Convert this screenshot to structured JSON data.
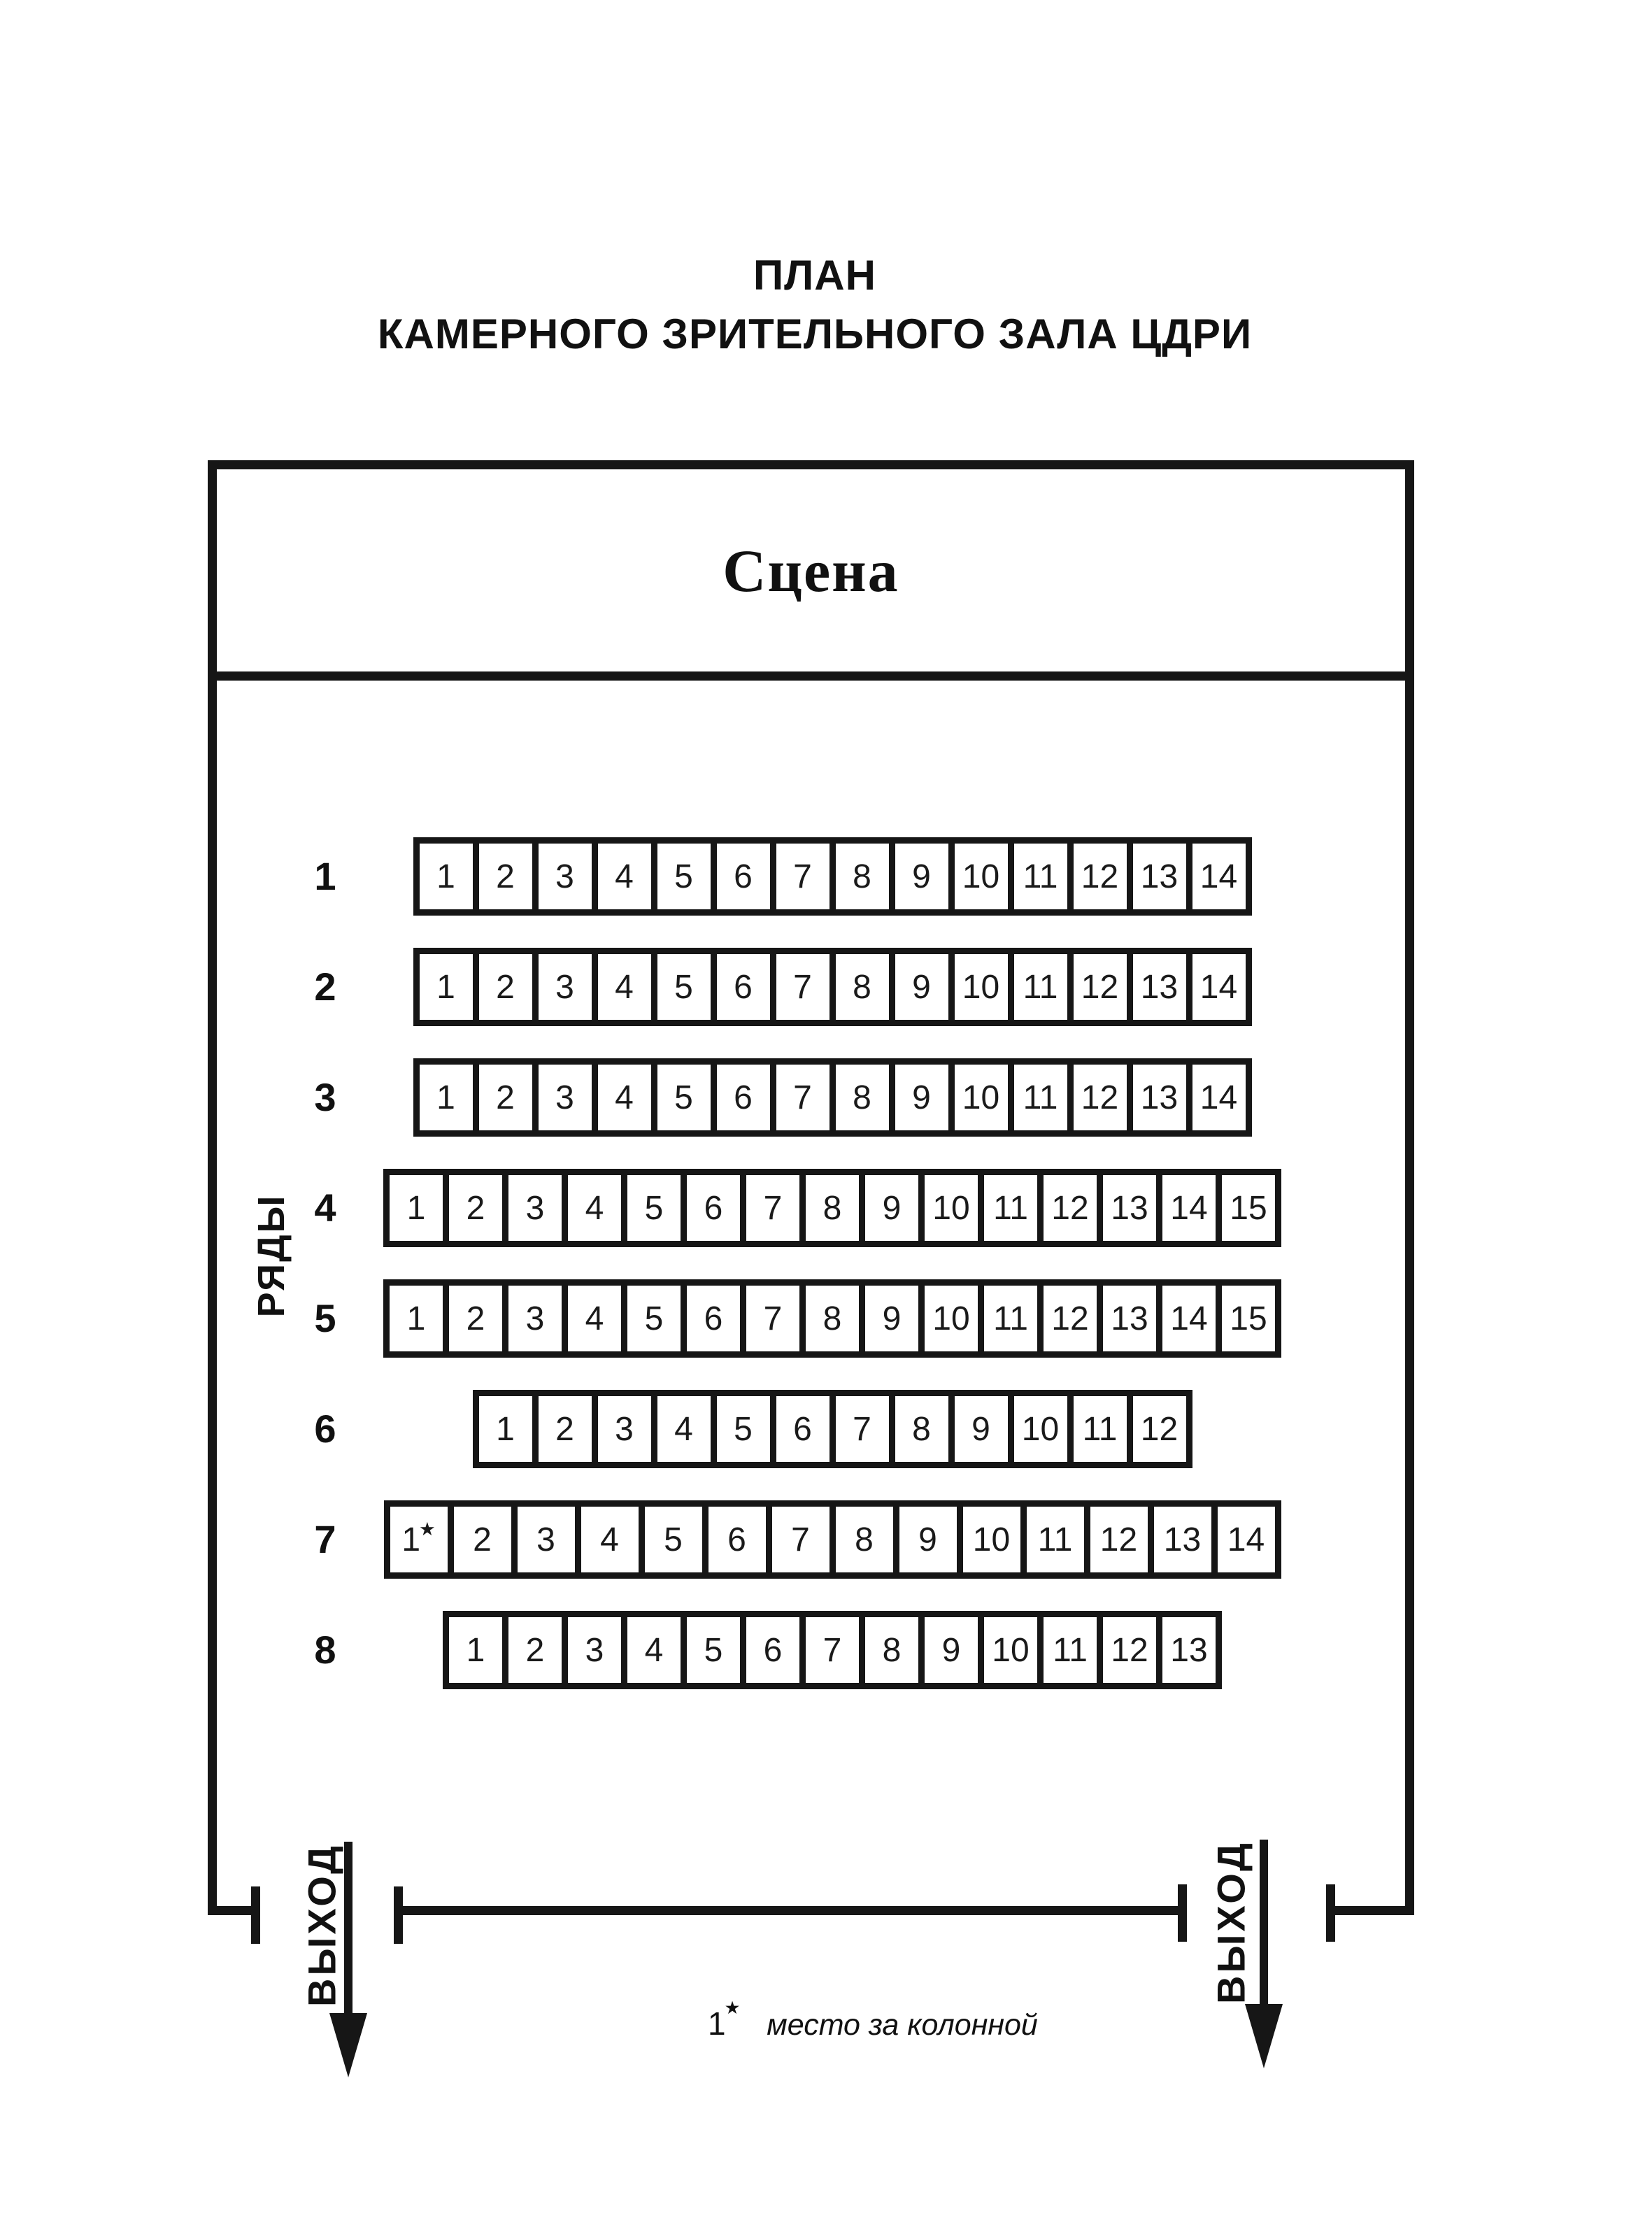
{
  "title": {
    "line1": "ПЛАН",
    "line2": "КАМЕРНОГО ЗРИТЕЛЬНОГО ЗАЛА ЦДРИ"
  },
  "stage": {
    "label": "Сцена"
  },
  "seating": {
    "axis_label": "РЯДЫ",
    "star_glyph": "★",
    "rows": [
      {
        "number": "1",
        "seats": [
          "1",
          "2",
          "3",
          "4",
          "5",
          "6",
          "7",
          "8",
          "9",
          "10",
          "11",
          "12",
          "13",
          "14"
        ]
      },
      {
        "number": "2",
        "seats": [
          "1",
          "2",
          "3",
          "4",
          "5",
          "6",
          "7",
          "8",
          "9",
          "10",
          "11",
          "12",
          "13",
          "14"
        ]
      },
      {
        "number": "3",
        "seats": [
          "1",
          "2",
          "3",
          "4",
          "5",
          "6",
          "7",
          "8",
          "9",
          "10",
          "11",
          "12",
          "13",
          "14"
        ]
      },
      {
        "number": "4",
        "seats": [
          "1",
          "2",
          "3",
          "4",
          "5",
          "6",
          "7",
          "8",
          "9",
          "10",
          "11",
          "12",
          "13",
          "14",
          "15"
        ]
      },
      {
        "number": "5",
        "seats": [
          "1",
          "2",
          "3",
          "4",
          "5",
          "6",
          "7",
          "8",
          "9",
          "10",
          "11",
          "12",
          "13",
          "14",
          "15"
        ]
      },
      {
        "number": "6",
        "seats": [
          "1",
          "2",
          "3",
          "4",
          "5",
          "6",
          "7",
          "8",
          "9",
          "10",
          "11",
          "12"
        ]
      },
      {
        "number": "7",
        "seats": [
          "1*",
          "2",
          "3",
          "4",
          "5",
          "6",
          "7",
          "8",
          "9",
          "10",
          "11",
          "12",
          "13",
          "14"
        ]
      },
      {
        "number": "8",
        "seats": [
          "1",
          "2",
          "3",
          "4",
          "5",
          "6",
          "7",
          "8",
          "9",
          "10",
          "11",
          "12",
          "13"
        ]
      }
    ]
  },
  "exits": {
    "left_label": "ВЫХОД",
    "right_label": "ВЫХОД"
  },
  "footnote": {
    "marker": "1*",
    "text": "место за колонной"
  },
  "colors": {
    "ink": "#161616",
    "paper": "#ffffff"
  }
}
